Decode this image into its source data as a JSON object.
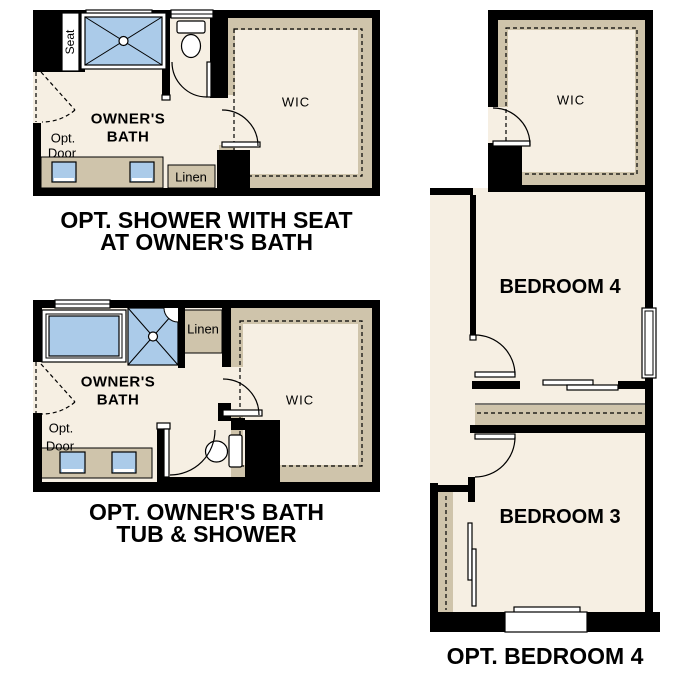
{
  "colors": {
    "wall": "#000000",
    "floor": "#f6efe3",
    "feature": "#cfc4ab",
    "fixture": "#abcbe9",
    "paper": "#ffffff",
    "ink": "#000000"
  },
  "plan_shower_seat": {
    "labels": {
      "seat": "Seat",
      "bath_line1": "OWNER'S",
      "bath_line2": "BATH",
      "opt": "Opt.",
      "door": "Door",
      "linen": "Linen",
      "wic": "WIC"
    },
    "caption_line1": "OPT. SHOWER WITH SEAT",
    "caption_line2": "AT OWNER'S BATH"
  },
  "plan_tub_shower": {
    "labels": {
      "bath_line1": "OWNER'S",
      "bath_line2": "BATH",
      "opt": "Opt.",
      "door": "Door",
      "linen": "Linen",
      "wic": "WIC"
    },
    "caption_line1": "OPT. OWNER'S BATH",
    "caption_line2": "TUB & SHOWER"
  },
  "plan_bedroom": {
    "labels": {
      "wic": "WIC",
      "bedroom4": "BEDROOM 4",
      "bedroom3": "BEDROOM 3"
    },
    "caption": "OPT. BEDROOM 4"
  }
}
